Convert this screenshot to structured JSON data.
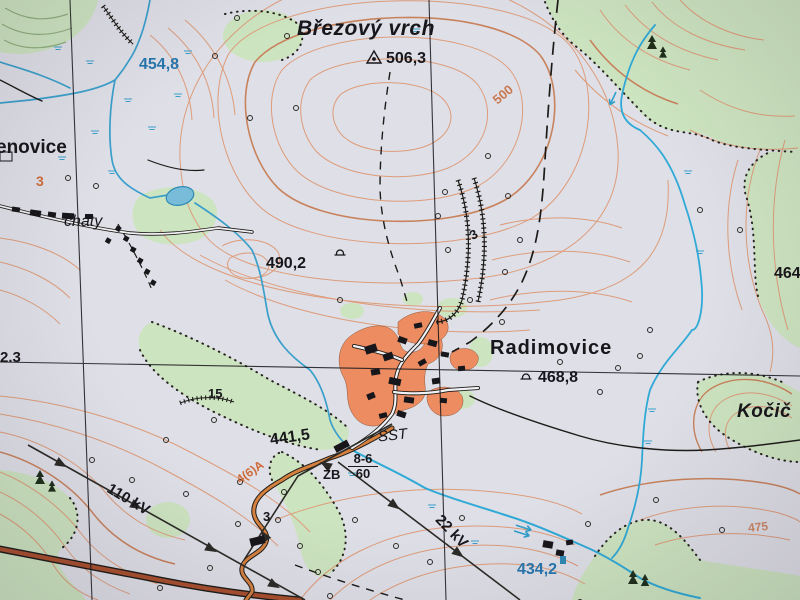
{
  "map": {
    "type": "topographic-map-photo",
    "language": "Czech",
    "labels": {
      "summit_name": "Březový vrch",
      "summit_elev": "506,3",
      "spot_454": "454,8",
      "village_enovice": "enovice",
      "road_3": "3",
      "chaty": "chaty",
      "spot_490": "490,2",
      "village_radimovice": "Radimovice",
      "spot_468": "468,8",
      "spot_441": "441,5",
      "sst": "SST",
      "bridge_material": "ŽB",
      "bridge_load_top": "8-6",
      "bridge_load_bottom": "60",
      "power_110": "110 kV",
      "power_22": "22 kV",
      "spot_434": "434,2",
      "spot_464": "464",
      "kocici": "Kočič",
      "contour_500": "500",
      "contour_475": "475",
      "cut_depth_3": "3",
      "scarp_15": "15",
      "edge_2_3": "2.3",
      "hairpin_3": "3",
      "road_class": "4(6)A"
    },
    "symbols": {
      "geodetic_point": "triangle-icon",
      "chapel": "bell-icon",
      "stream_flow": "arrow-icon",
      "tree": "circle-icon",
      "conifer": "spruce-icon",
      "marsh": "double-tick-icon"
    },
    "colors": {
      "paper": "#dfdfe7",
      "contour": "#dd9c7a",
      "contour_index": "#c8825c",
      "forest_green": "#cde4c0",
      "green_contour": "#8fae7e",
      "water": "#3a9fca",
      "water_text": "#2676ad",
      "builtup": "#ec8c60",
      "road_major_fill": "#a94f2e",
      "road_minor_fill": "#d4803f",
      "ink": "#17161a",
      "contour_text": "#c97850"
    }
  }
}
